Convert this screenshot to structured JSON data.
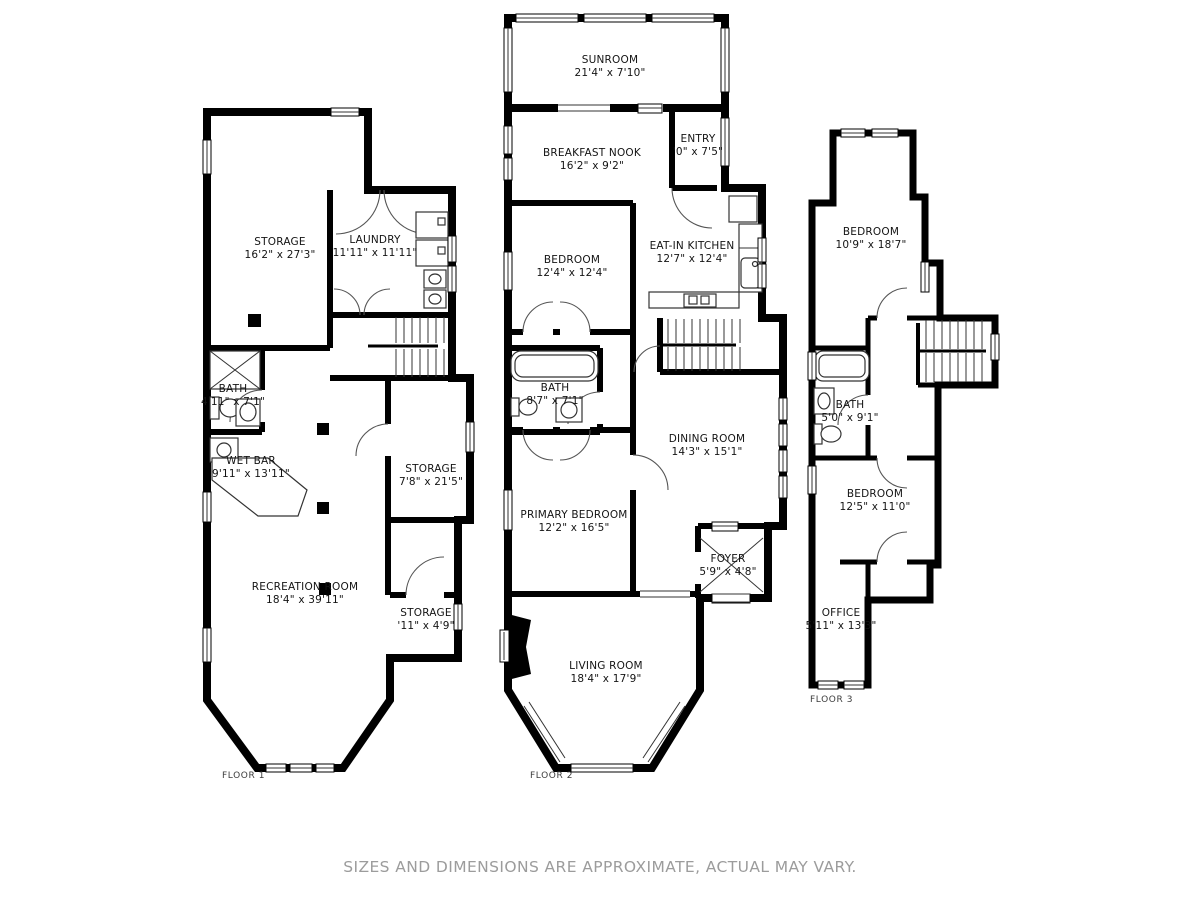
{
  "disclaimer": "SIZES AND DIMENSIONS ARE APPROXIMATE, ACTUAL MAY VARY.",
  "colors": {
    "wall": "#000000",
    "room_text": "#141414",
    "floor_tag_text": "#3c3c3c",
    "disclaimer_text": "#9c9c9c",
    "background": "#ffffff"
  },
  "floors": [
    {
      "label": "FLOOR 1",
      "rooms": [
        {
          "name": "STORAGE",
          "dims": "16'2\" x 27'3\""
        },
        {
          "name": "LAUNDRY",
          "dims": "11'11\" x 11'11\""
        },
        {
          "name": "BATH",
          "dims": "4'11\" x 7'1\""
        },
        {
          "name": "WET BAR",
          "dims": "9'11\" x 13'11\""
        },
        {
          "name": "STORAGE",
          "dims": "7'8\" x 21'5\""
        },
        {
          "name": "RECREATION ROOM",
          "dims": "18'4\" x 39'11\""
        },
        {
          "name": "STORAGE",
          "dims": "'11\" x 4'9\""
        }
      ]
    },
    {
      "label": "FLOOR 2",
      "rooms": [
        {
          "name": "SUNROOM",
          "dims": "21'4\" x 7'10\""
        },
        {
          "name": "BREAKFAST NOOK",
          "dims": "16'2\" x 9'2\""
        },
        {
          "name": "ENTRY",
          "dims": "'0\" x 7'5\""
        },
        {
          "name": "BEDROOM",
          "dims": "12'4\" x 12'4\""
        },
        {
          "name": "EAT-IN KITCHEN",
          "dims": "12'7\" x 12'4\""
        },
        {
          "name": "BATH",
          "dims": "8'7\" x 7'1\""
        },
        {
          "name": "DINING ROOM",
          "dims": "14'3\" x 15'1\""
        },
        {
          "name": "PRIMARY BEDROOM",
          "dims": "12'2\" x 16'5\""
        },
        {
          "name": "FOYER",
          "dims": "5'9\" x 4'8\""
        },
        {
          "name": "LIVING ROOM",
          "dims": "18'4\" x 17'9\""
        }
      ]
    },
    {
      "label": "FLOOR 3",
      "rooms": [
        {
          "name": "BEDROOM",
          "dims": "10'9\" x 18'7\""
        },
        {
          "name": "BATH",
          "dims": "5'0\" x 9'1\""
        },
        {
          "name": "BEDROOM",
          "dims": "12'5\" x 11'0\""
        },
        {
          "name": "OFFICE",
          "dims": "5'11\" x 13'3\""
        }
      ]
    }
  ]
}
